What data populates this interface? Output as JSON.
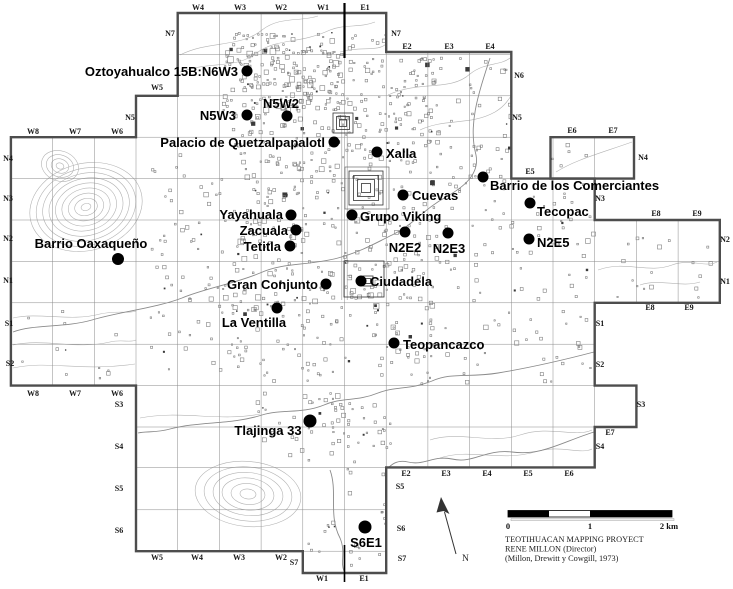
{
  "map_name": "Teotihuacan archaeological grid map",
  "sites": [
    {
      "name": "Oztoyahualco 15B:N6W3",
      "dot": {
        "x": 247,
        "y": 71,
        "r": 5.5
      },
      "label": {
        "x": 238,
        "y": 76,
        "anchor": "end"
      }
    },
    {
      "name": "N5W2",
      "dot": {
        "x": 287,
        "y": 116,
        "r": 5.5
      },
      "label": {
        "x": 281,
        "y": 108,
        "anchor": "middle"
      }
    },
    {
      "name": "N5W3",
      "dot": {
        "x": 247,
        "y": 115,
        "r": 5.5
      },
      "label": {
        "x": 236,
        "y": 120,
        "anchor": "end"
      }
    },
    {
      "name": "Palacio de Quetzalpapalotl",
      "dot": {
        "x": 334,
        "y": 142,
        "r": 5.5
      },
      "label": {
        "x": 325,
        "y": 147,
        "anchor": "end"
      }
    },
    {
      "name": "Xalla",
      "dot": {
        "x": 377,
        "y": 152,
        "r": 5.5
      },
      "label": {
        "x": 386,
        "y": 158,
        "anchor": "start"
      }
    },
    {
      "name": "Cuevas",
      "dot": {
        "x": 403,
        "y": 195,
        "r": 5.5
      },
      "label": {
        "x": 412,
        "y": 200,
        "anchor": "start"
      }
    },
    {
      "name": "Barrio de los Comerciantes",
      "dot": {
        "x": 483,
        "y": 177,
        "r": 5.5
      },
      "label": {
        "x": 490,
        "y": 190,
        "anchor": "start"
      }
    },
    {
      "name": "Grupo Viking",
      "dot": {
        "x": 352,
        "y": 215,
        "r": 5.5
      },
      "label": {
        "x": 360,
        "y": 221,
        "anchor": "start"
      }
    },
    {
      "name": "Tecopac",
      "dot": {
        "x": 530,
        "y": 203,
        "r": 5.5
      },
      "label": {
        "x": 537,
        "y": 216,
        "anchor": "start"
      }
    },
    {
      "name": "N2E2",
      "dot": {
        "x": 405,
        "y": 232,
        "r": 5.5
      },
      "label": {
        "x": 405,
        "y": 252,
        "anchor": "middle"
      }
    },
    {
      "name": "N2E3",
      "dot": {
        "x": 448,
        "y": 233,
        "r": 5.5
      },
      "label": {
        "x": 449,
        "y": 253,
        "anchor": "middle"
      }
    },
    {
      "name": "N2E5",
      "dot": {
        "x": 529,
        "y": 239,
        "r": 5.5
      },
      "label": {
        "x": 537,
        "y": 247,
        "anchor": "start"
      }
    },
    {
      "name": "Yayahuala",
      "dot": {
        "x": 291,
        "y": 215,
        "r": 5.5
      },
      "label": {
        "x": 283,
        "y": 219,
        "anchor": "end"
      }
    },
    {
      "name": "Zacuala",
      "dot": {
        "x": 296,
        "y": 230,
        "r": 5.5
      },
      "label": {
        "x": 288,
        "y": 235,
        "anchor": "end"
      }
    },
    {
      "name": "Tetitla",
      "dot": {
        "x": 290,
        "y": 246,
        "r": 5.5
      },
      "label": {
        "x": 281,
        "y": 251,
        "anchor": "end"
      }
    },
    {
      "name": "Barrio Oaxaqueño",
      "dot": {
        "x": 118,
        "y": 259,
        "r": 6
      },
      "label": {
        "x": 91,
        "y": 248,
        "anchor": "middle"
      }
    },
    {
      "name": "Gran Conjunto",
      "dot": {
        "x": 326,
        "y": 284,
        "r": 5.5
      },
      "label": {
        "x": 318,
        "y": 289,
        "anchor": "end"
      }
    },
    {
      "name": "Ciudadela",
      "dot": {
        "x": 361,
        "y": 281,
        "r": 5.5
      },
      "label": {
        "x": 370,
        "y": 286,
        "anchor": "start"
      }
    },
    {
      "name": "La Ventilla",
      "dot": {
        "x": 277,
        "y": 308,
        "r": 5.5
      },
      "label": {
        "x": 254,
        "y": 327,
        "anchor": "middle"
      }
    },
    {
      "name": "Teopancazco",
      "dot": {
        "x": 394,
        "y": 343,
        "r": 5.5
      },
      "label": {
        "x": 403,
        "y": 349,
        "anchor": "start"
      }
    },
    {
      "name": "Tlajinga 33",
      "dot": {
        "x": 310,
        "y": 421,
        "r": 6.5
      },
      "label": {
        "x": 268,
        "y": 435,
        "anchor": "middle"
      }
    },
    {
      "name": "S6E1",
      "dot": {
        "x": 365,
        "y": 527,
        "r": 6.5
      },
      "label": {
        "x": 366,
        "y": 547,
        "anchor": "middle"
      }
    }
  ],
  "grid_labels": [
    {
      "t": "W4",
      "x": 198,
      "y": 10
    },
    {
      "t": "W3",
      "x": 240,
      "y": 10
    },
    {
      "t": "W2",
      "x": 281,
      "y": 10
    },
    {
      "t": "W1",
      "x": 323,
      "y": 10
    },
    {
      "t": "E1",
      "x": 365,
      "y": 10
    },
    {
      "t": "N7",
      "x": 170,
      "y": 36
    },
    {
      "t": "N7",
      "x": 396,
      "y": 36
    },
    {
      "t": "E2",
      "x": 407,
      "y": 49
    },
    {
      "t": "E3",
      "x": 449,
      "y": 49
    },
    {
      "t": "E4",
      "x": 490,
      "y": 49
    },
    {
      "t": "N6",
      "x": 519,
      "y": 78
    },
    {
      "t": "N5",
      "x": 517,
      "y": 120
    },
    {
      "t": "W5",
      "x": 157,
      "y": 90
    },
    {
      "t": "N5",
      "x": 130,
      "y": 120
    },
    {
      "t": "E6",
      "x": 572,
      "y": 133
    },
    {
      "t": "E7",
      "x": 613,
      "y": 133
    },
    {
      "t": "W8",
      "x": 33,
      "y": 134
    },
    {
      "t": "W7",
      "x": 75,
      "y": 134
    },
    {
      "t": "W6",
      "x": 117,
      "y": 134
    },
    {
      "t": "N4",
      "x": 8,
      "y": 161
    },
    {
      "t": "N4",
      "x": 643,
      "y": 160
    },
    {
      "t": "E5",
      "x": 530,
      "y": 174
    },
    {
      "t": "N3",
      "x": 8,
      "y": 201
    },
    {
      "t": "N3",
      "x": 600,
      "y": 201
    },
    {
      "t": "E8",
      "x": 656,
      "y": 216
    },
    {
      "t": "E9",
      "x": 697,
      "y": 216
    },
    {
      "t": "N2",
      "x": 8,
      "y": 241
    },
    {
      "t": "N2",
      "x": 725,
      "y": 242
    },
    {
      "t": "N1",
      "x": 8,
      "y": 283
    },
    {
      "t": "N1",
      "x": 725,
      "y": 284
    },
    {
      "t": "E8",
      "x": 650,
      "y": 310
    },
    {
      "t": "E9",
      "x": 689,
      "y": 310
    },
    {
      "t": "S1",
      "x": 9,
      "y": 326
    },
    {
      "t": "S1",
      "x": 600,
      "y": 326
    },
    {
      "t": "S2",
      "x": 10,
      "y": 366
    },
    {
      "t": "S2",
      "x": 600,
      "y": 367
    },
    {
      "t": "W8",
      "x": 33,
      "y": 396
    },
    {
      "t": "W7",
      "x": 75,
      "y": 396
    },
    {
      "t": "W6",
      "x": 117,
      "y": 396
    },
    {
      "t": "S3",
      "x": 119,
      "y": 407
    },
    {
      "t": "S3",
      "x": 641,
      "y": 407
    },
    {
      "t": "E7",
      "x": 610,
      "y": 435
    },
    {
      "t": "S4",
      "x": 119,
      "y": 449
    },
    {
      "t": "S4",
      "x": 600,
      "y": 449
    },
    {
      "t": "E2",
      "x": 406,
      "y": 476
    },
    {
      "t": "E3",
      "x": 446,
      "y": 476
    },
    {
      "t": "E4",
      "x": 487,
      "y": 476
    },
    {
      "t": "E5",
      "x": 528,
      "y": 476
    },
    {
      "t": "E6",
      "x": 569,
      "y": 476
    },
    {
      "t": "S5",
      "x": 119,
      "y": 491
    },
    {
      "t": "S5",
      "x": 400,
      "y": 489
    },
    {
      "t": "S6",
      "x": 119,
      "y": 533
    },
    {
      "t": "S6",
      "x": 401,
      "y": 531
    },
    {
      "t": "S7",
      "x": 294,
      "y": 565
    },
    {
      "t": "S7",
      "x": 402,
      "y": 561
    },
    {
      "t": "W5",
      "x": 157,
      "y": 560
    },
    {
      "t": "W4",
      "x": 197,
      "y": 560
    },
    {
      "t": "W3",
      "x": 239,
      "y": 560
    },
    {
      "t": "W2",
      "x": 281,
      "y": 560
    },
    {
      "t": "W1",
      "x": 322,
      "y": 581
    },
    {
      "t": "E1",
      "x": 364,
      "y": 581
    }
  ],
  "north": {
    "label": "N"
  },
  "scale_bar": {
    "tick_0": "0",
    "tick_1": "1",
    "tick_2": "2 km"
  },
  "credits": {
    "line1": "TEOTIHUACAN MAPPING PROYECT",
    "line2": "RENE MILLON (Director)",
    "line3": "(Millon, Drewitt y Cowgill, 1973)"
  },
  "colors": {
    "ink": "#000000",
    "border": "#4d4d4d",
    "grid": "#8a8a8a",
    "texture": "#757575",
    "contour": "#b3b3b3",
    "river": "#8a8a8a"
  }
}
